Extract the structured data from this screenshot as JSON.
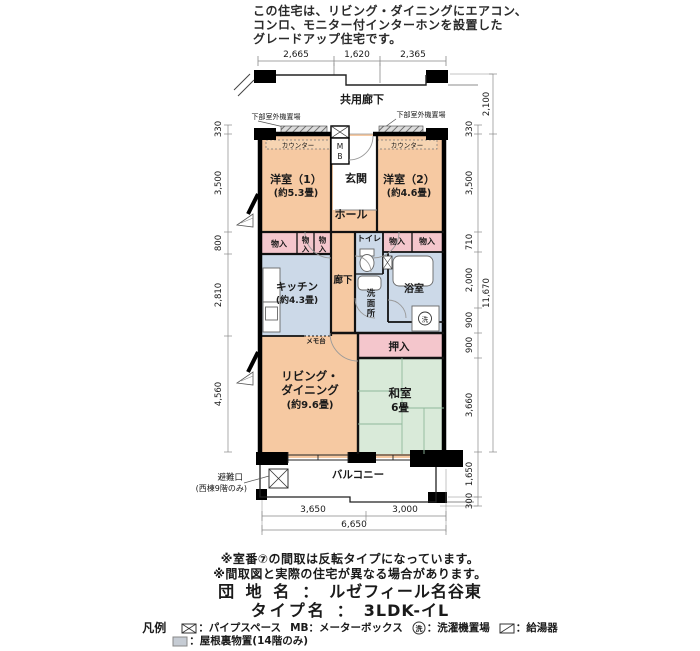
{
  "header": {
    "lines": [
      "この住宅は、リビング・ダイニングにエアコン、",
      "コンロ、モニター付インターホンを設置した",
      "グレードアップ住宅です。"
    ]
  },
  "plan": {
    "corridor_label": "共用廊下",
    "outdoor_unit_label": "下部室外機置場",
    "counter_label": "カウンター",
    "mb_chars": [
      "M",
      "B"
    ],
    "rooms": {
      "genkan": "玄関",
      "yo1_name": "洋室（1）",
      "yo1_size": "(約5.3畳)",
      "yo2_name": "洋室（2）",
      "yo2_size": "(約4.6畳)",
      "hall": "ホール",
      "monoire": "物入",
      "monoire_chars": [
        "物",
        "入"
      ],
      "toilet": "トイレ",
      "kitchen_name": "キッチン",
      "kitchen_size": "(約4.3畳)",
      "corridor": "廊下",
      "washroom_chars": [
        "洗",
        "面",
        "所"
      ],
      "bath": "浴室",
      "laundry_char": "洗",
      "memo": "メモ台",
      "oshiire": "押入",
      "living_1": "リビング・",
      "living_2": "ダイニング",
      "living_size": "(約9.6畳)",
      "washitsu": "和室",
      "washitsu_size": "6畳",
      "balcony": "バルコニー"
    },
    "hinan": [
      "避難口",
      "(西棟9階のみ)"
    ],
    "dims": {
      "top": [
        "2,665",
        "1,620",
        "2,365"
      ],
      "left": [
        "330",
        "3,500",
        "800",
        "2,810",
        "4,560"
      ],
      "right": [
        "330",
        "3,500",
        "710",
        "2,000",
        "900",
        "900",
        "3,660",
        "1,650",
        "300"
      ],
      "right_outer": [
        "2,100",
        "11,670"
      ],
      "bottom": [
        "3,650",
        "3,000"
      ],
      "bottom_total": "6,650"
    },
    "colors": {
      "room_peach": "#f6c9a2",
      "wet_blue": "#ccd9e8",
      "closet_pink": "#f4c6cc",
      "tatami_green": "#d9ead9",
      "wall_black": "#000000"
    }
  },
  "footer": {
    "note1": "※室番⑦の間取は反転タイプになっています。",
    "note2": "※間取図と実際の住宅が異なる場合があります。",
    "estate": {
      "label": "団 地 名",
      "sep": "：",
      "name": "ルゼフィール名谷東"
    },
    "type": {
      "label": "タイプ名",
      "sep": "：",
      "name": "3LDK-イL"
    },
    "legend": {
      "title": "凡例",
      "laundry_char": "洗",
      "items": [
        {
          "label": "：パイプスペース"
        },
        {
          "label": "MB：メーターボックス"
        },
        {
          "label": "：洗濯機置場"
        },
        {
          "label": "：給湯器"
        },
        {
          "label": "：屋根裏物置(14階のみ)"
        }
      ]
    }
  }
}
